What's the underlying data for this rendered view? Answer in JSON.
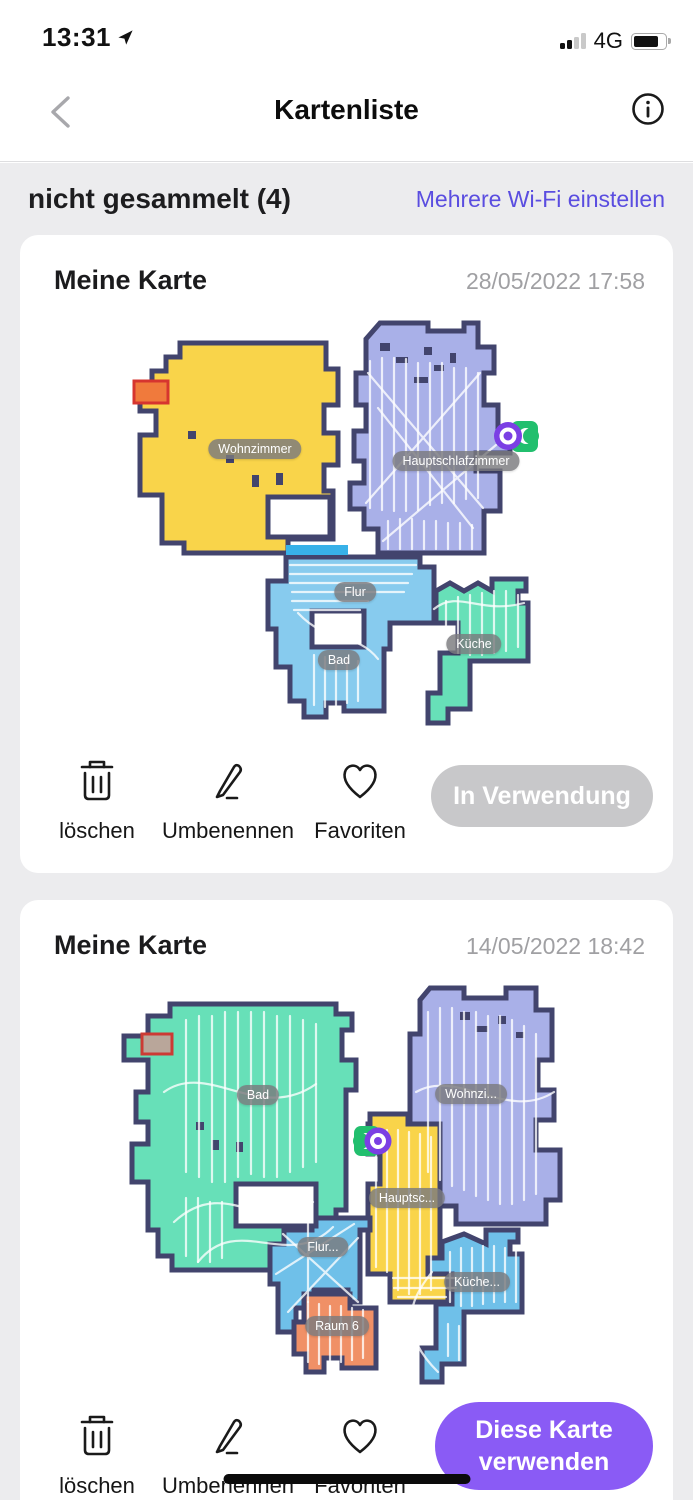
{
  "status_bar": {
    "time": "13:31",
    "network": "4G"
  },
  "nav": {
    "title": "Kartenliste"
  },
  "section": {
    "title": "nicht gesammelt (4)",
    "link": "Mehrere Wi-Fi einstellen"
  },
  "cards": [
    {
      "title": "Meine Karte",
      "date": "28/05/2022 17:58",
      "rooms": [
        "Wohnzimmer",
        "Hauptschlafzimmer",
        "Flur",
        "Bad",
        "Küche"
      ],
      "actions": {
        "delete": "löschen",
        "rename": "Umbenennen",
        "favorite": "Favoriten"
      },
      "use_button": "In Verwendung",
      "use_button_state": "in-use-disabled"
    },
    {
      "title": "Meine Karte",
      "date": "14/05/2022 18:42",
      "rooms": [
        "Bad",
        "Wohnzi...",
        "Hauptsc...",
        "Flur...",
        "Raum 6",
        "Küche..."
      ],
      "actions": {
        "delete": "löschen",
        "rename": "Umbenennen",
        "favorite": "Favoriten"
      },
      "use_button": "Diese Karte verwenden",
      "use_button_state": "primary"
    }
  ],
  "colors": {
    "accent_purple": "#8a5bf5",
    "link_purple": "#5a4de0",
    "disabled_pill": "#c8c8ca",
    "wall": "#42446d",
    "room_yellow": "#f9d44a",
    "room_lavender": "#a9b0e8",
    "room_lightblue": "#87cbee",
    "room_teal": "#67e0b8",
    "room_blue": "#6fc0e9",
    "room_orange": "#f09066",
    "robot_purple": "#7b3fe4",
    "dock_green": "#22bf6e",
    "doorway_cyan": "#38b1e8"
  }
}
